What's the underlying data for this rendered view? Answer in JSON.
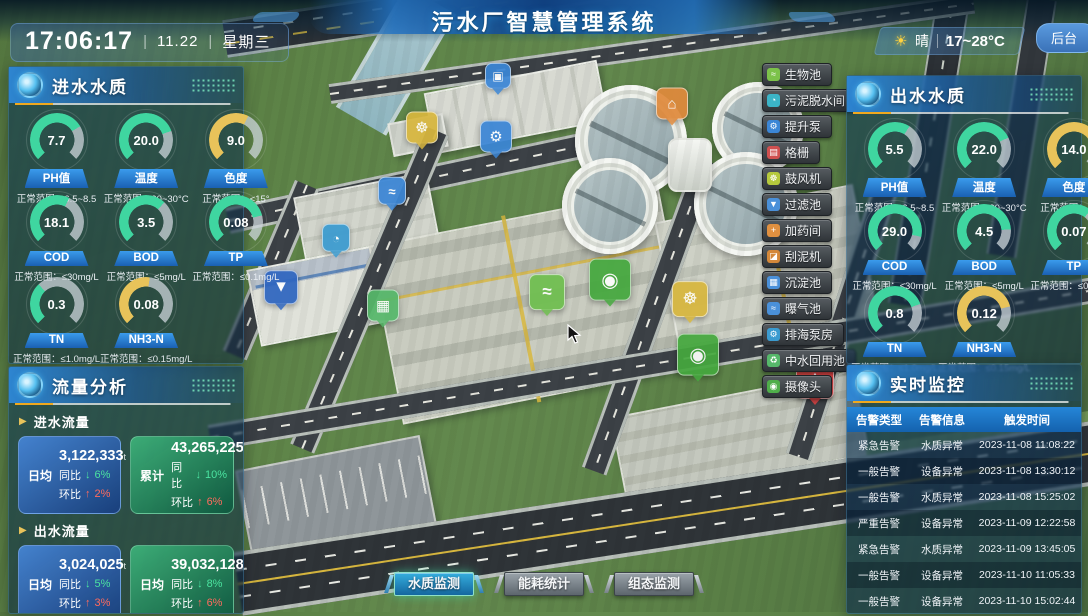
{
  "header": {
    "title": "污水厂智慧管理系统",
    "time": "17:06:17",
    "separator": "|",
    "date": "11.22",
    "weekday": "星期三",
    "weather": {
      "icon": "☀",
      "condition": "晴",
      "range": "17~28°C"
    },
    "backend_label": "后台"
  },
  "inlet_panel": {
    "title": "进水水质",
    "gauges": [
      {
        "label": "PH值",
        "value": "7.7",
        "range": "正常范围：6.5~8.5",
        "color": "#3fd6a0",
        "percent": 72
      },
      {
        "label": "温度",
        "value": "20.0",
        "range": "正常范围：20~30°C",
        "color": "#3fd6a0",
        "percent": 76
      },
      {
        "label": "色度",
        "value": "9.0",
        "range": "正常范围：<15°",
        "color": "#e8c35a",
        "percent": 60
      },
      {
        "label": "COD",
        "value": "18.1",
        "range": "正常范围：≤30mg/L",
        "color": "#3fd6a0",
        "percent": 60
      },
      {
        "label": "BOD",
        "value": "3.5",
        "range": "正常范围：≤5mg/L",
        "color": "#3fd6a0",
        "percent": 66
      },
      {
        "label": "TP",
        "value": "0.08",
        "range": "正常范围：≤0.1mg/L",
        "color": "#3fd6a0",
        "percent": 78
      },
      {
        "label": "TN",
        "value": "0.3",
        "range": "正常范围：≤1.0mg/L",
        "color": "#3fd6a0",
        "percent": 34
      },
      {
        "label": "NH3-N",
        "value": "0.08",
        "range": "正常范围：≤0.15mg/L",
        "color": "#e8c35a",
        "percent": 53
      }
    ]
  },
  "outlet_panel": {
    "title": "出水水质",
    "gauges": [
      {
        "label": "PH值",
        "value": "5.5",
        "range": "正常范围：6.5~8.5",
        "color": "#3fd6a0",
        "percent": 62
      },
      {
        "label": "温度",
        "value": "22.0",
        "range": "正常范围：20~30°C",
        "color": "#3fd6a0",
        "percent": 74
      },
      {
        "label": "色度",
        "value": "14.0",
        "range": "正常范围：<15°",
        "color": "#e8c35a",
        "percent": 86
      },
      {
        "label": "COD",
        "value": "29.0",
        "range": "正常范围：≤30mg/L",
        "color": "#3fd6a0",
        "percent": 88
      },
      {
        "label": "BOD",
        "value": "4.5",
        "range": "正常范围：≤5mg/L",
        "color": "#3fd6a0",
        "percent": 82
      },
      {
        "label": "TP",
        "value": "0.07",
        "range": "正常范围：≤0.1mg/L",
        "color": "#3fd6a0",
        "percent": 64
      },
      {
        "label": "TN",
        "value": "0.8",
        "range": "正常范围：≤1.0mg/L",
        "color": "#3fd6a0",
        "percent": 76
      },
      {
        "label": "NH3-N",
        "value": "0.12",
        "range": "正常范围：≤0.15mg/L",
        "color": "#e8c35a",
        "percent": 78
      }
    ]
  },
  "flow_panel": {
    "title": "流量分析",
    "arrow_icon": "▶",
    "inlet_section_label": "进水流量",
    "outlet_section_label": "出水流量",
    "inlet_cards": [
      {
        "tag": "日均",
        "value": "3,122,333",
        "unit": "t",
        "theme": "blue",
        "yoy_label": "同比",
        "yoy_arrow": "↓",
        "yoy_pct": "6%",
        "mom_label": "环比",
        "mom_arrow": "↑",
        "mom_pct": "2%"
      },
      {
        "tag": "累计",
        "value": "43,265,225",
        "unit": "t",
        "theme": "green",
        "yoy_label": "同比",
        "yoy_arrow": "↓",
        "yoy_pct": "10%",
        "mom_label": "环比",
        "mom_arrow": "↑",
        "mom_pct": "6%"
      }
    ],
    "outlet_cards": [
      {
        "tag": "日均",
        "value": "3,024,025",
        "unit": "t",
        "theme": "blue",
        "yoy_label": "同比",
        "yoy_arrow": "↓",
        "yoy_pct": "5%",
        "mom_label": "环比",
        "mom_arrow": "↑",
        "mom_pct": "3%"
      },
      {
        "tag": "日均",
        "value": "39,032,128",
        "unit": "t",
        "theme": "green",
        "yoy_label": "同比",
        "yoy_arrow": "↓",
        "yoy_pct": "8%",
        "mom_label": "环比",
        "mom_arrow": "↑",
        "mom_pct": "6%"
      }
    ]
  },
  "monitor_panel": {
    "title": "实时监控",
    "columns": [
      "告警类型",
      "告警信息",
      "触发时间"
    ],
    "rows": [
      [
        "紧急告警",
        "水质异常",
        "2023-11-08 11:08:22"
      ],
      [
        "一般告警",
        "设备异常",
        "2023-11-08 13:30:12"
      ],
      [
        "一般告警",
        "水质异常",
        "2023-11-08 15:25:02"
      ],
      [
        "严重告警",
        "设备异常",
        "2023-11-09 12:22:58"
      ],
      [
        "紧急告警",
        "水质异常",
        "2023-11-09 13:45:05"
      ],
      [
        "一般告警",
        "设备异常",
        "2023-11-10 11:05:33"
      ],
      [
        "一般告警",
        "设备异常",
        "2023-11-10 15:02:44"
      ]
    ]
  },
  "equipment_menu": [
    {
      "name": "equipment-button-bio-pool",
      "label": "生物池",
      "glyph": "≈",
      "color": "#7cc24a"
    },
    {
      "name": "equipment-button-sludge-dewater",
      "label": "污泥脱水间",
      "glyph": "◔",
      "color": "#3bb4c7"
    },
    {
      "name": "equipment-button-lift-pump",
      "label": "提升泵",
      "glyph": "⚙",
      "color": "#3b86d6"
    },
    {
      "name": "equipment-button-grille",
      "label": "格栅",
      "glyph": "▤",
      "color": "#d05050"
    },
    {
      "name": "equipment-button-blower",
      "label": "鼓风机",
      "glyph": "☸",
      "color": "#b5c93c"
    },
    {
      "name": "equipment-button-filter-pool",
      "label": "过滤池",
      "glyph": "▼",
      "color": "#4a90d9"
    },
    {
      "name": "equipment-button-dosing-room",
      "label": "加药间",
      "glyph": "+",
      "color": "#e09040"
    },
    {
      "name": "equipment-button-scraper",
      "label": "刮泥机",
      "glyph": "◪",
      "color": "#d4883a"
    },
    {
      "name": "equipment-button-sedimentation",
      "label": "沉淀池",
      "glyph": "▦",
      "color": "#4a90d9"
    },
    {
      "name": "equipment-button-aeration-pool",
      "label": "曝气池",
      "glyph": "≈",
      "color": "#4a90d9"
    },
    {
      "name": "equipment-button-sea-pump-house",
      "label": "排海泵房",
      "glyph": "⚙",
      "color": "#3b9bd0"
    },
    {
      "name": "equipment-button-reclaimed-pool",
      "label": "中水回用池",
      "glyph": "♻",
      "color": "#56b86a"
    },
    {
      "name": "equipment-button-camera",
      "label": "摄像头",
      "glyph": "◉",
      "color": "#4fae4a"
    }
  ],
  "map_markers": [
    {
      "name": "map-marker-sedimentation",
      "glyph": "▣",
      "color": "#3b86d6",
      "x": 498,
      "y": 78,
      "size": 24
    },
    {
      "name": "map-marker-blower-1",
      "glyph": "☸",
      "color": "#d8b73e",
      "x": 422,
      "y": 130,
      "size": 30
    },
    {
      "name": "map-marker-lift-pump",
      "glyph": "⚙",
      "color": "#3b86d6",
      "x": 496,
      "y": 139,
      "size": 30
    },
    {
      "name": "map-marker-dosing-room",
      "glyph": "⌂",
      "color": "#e08a3c",
      "x": 672,
      "y": 106,
      "size": 30
    },
    {
      "name": "map-marker-aeration",
      "glyph": "≈",
      "color": "#3b86d6",
      "x": 392,
      "y": 193,
      "size": 26
    },
    {
      "name": "map-marker-dewatering",
      "glyph": "◔",
      "color": "#3b9bd0",
      "x": 336,
      "y": 240,
      "size": 26
    },
    {
      "name": "map-marker-filter-pool",
      "glyph": "▼",
      "color": "#2f66c0",
      "x": 281,
      "y": 290,
      "size": 32
    },
    {
      "name": "map-marker-reuse-pool",
      "glyph": "▦",
      "color": "#56b86a",
      "x": 383,
      "y": 308,
      "size": 30
    },
    {
      "name": "map-marker-bio-pool",
      "glyph": "≈",
      "color": "#6fbf4f",
      "x": 547,
      "y": 295,
      "size": 34
    },
    {
      "name": "map-marker-camera-1",
      "glyph": "◉",
      "color": "#45a83e",
      "x": 610,
      "y": 283,
      "size": 40
    },
    {
      "name": "map-marker-blower-2",
      "glyph": "☸",
      "color": "#d8b73e",
      "x": 690,
      "y": 302,
      "size": 34
    },
    {
      "name": "map-marker-camera-2",
      "glyph": "◉",
      "color": "#45a83e",
      "x": 698,
      "y": 358,
      "size": 40
    },
    {
      "name": "map-marker-alarm",
      "glyph": "⚠",
      "color": "#d84040",
      "x": 815,
      "y": 383,
      "size": 36
    }
  ],
  "bottom_tabs": [
    {
      "name": "tab-water-quality-monitor",
      "label": "水质监测",
      "active": true
    },
    {
      "name": "tab-energy-stats",
      "label": "能耗统计",
      "active": false
    },
    {
      "name": "tab-scada-monitor",
      "label": "组态监测",
      "active": false
    }
  ]
}
